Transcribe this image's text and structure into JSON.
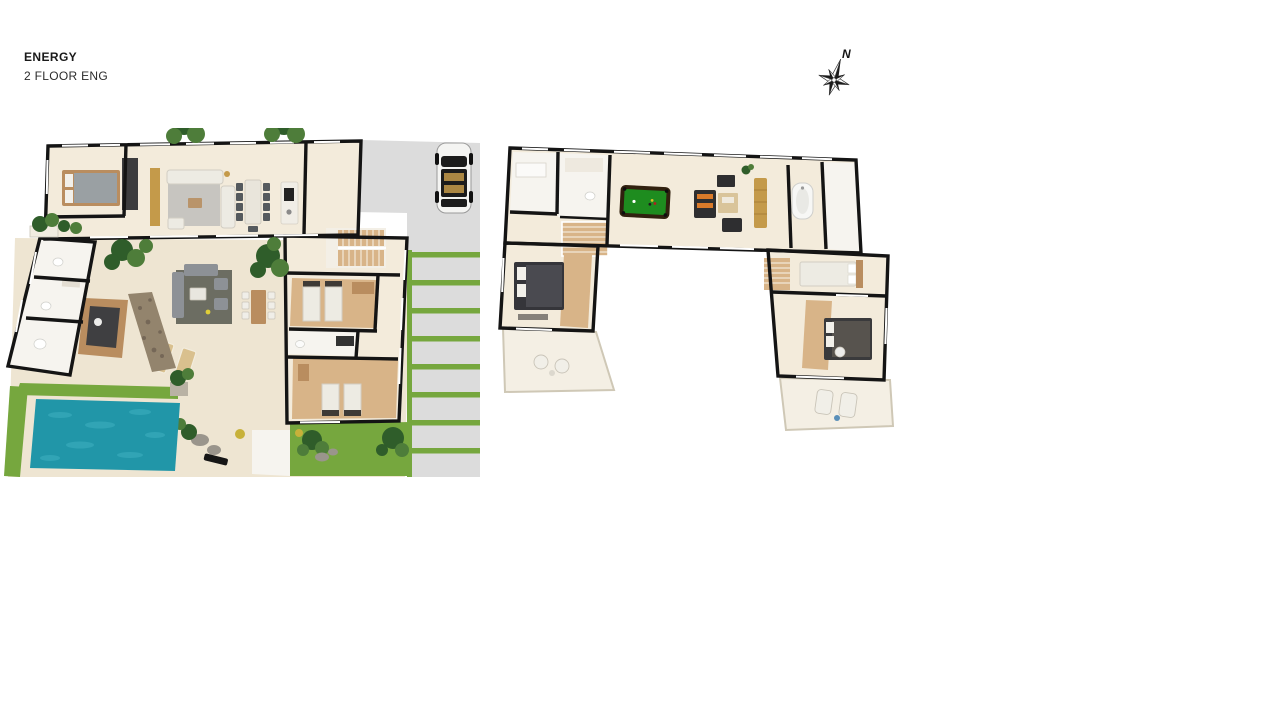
{
  "header": {
    "title": "ENERGY",
    "subtitle": "2 FLOOR ENG"
  },
  "compass": {
    "label": "N"
  },
  "colors": {
    "background": "#ffffff",
    "wall": "#141414",
    "floor_cream": "#f3ebdb",
    "floor_white": "#f6f4ef",
    "floor_wood": "#d8b488",
    "wood_dark": "#b98d5f",
    "terrace_tile": "#eee5d2",
    "terrace_light": "#f4efe4",
    "pool_water": "#2196a8",
    "pool_ripple": "#45b7c6",
    "grass": "#76a73e",
    "grass_dark": "#5e9333",
    "concrete": "#dcdcdc",
    "concrete_light": "#e9e9e9",
    "billiard_green": "#1e8c1f",
    "billiard_frame": "#31210f",
    "sofa_white": "#edebe3",
    "sofa_gray": "#8d9196",
    "rug_gray": "#c7c5c0",
    "rug_dark": "#55584f",
    "furniture_dark": "#2e2e30",
    "gold": "#c49a4a",
    "orange": "#d97a2a",
    "tree_green": "#2f5d2a",
    "tree_light": "#4e7d3a",
    "car_body": "#f4f4f2",
    "car_dark": "#1c1c1c",
    "stone": "#93846d"
  }
}
